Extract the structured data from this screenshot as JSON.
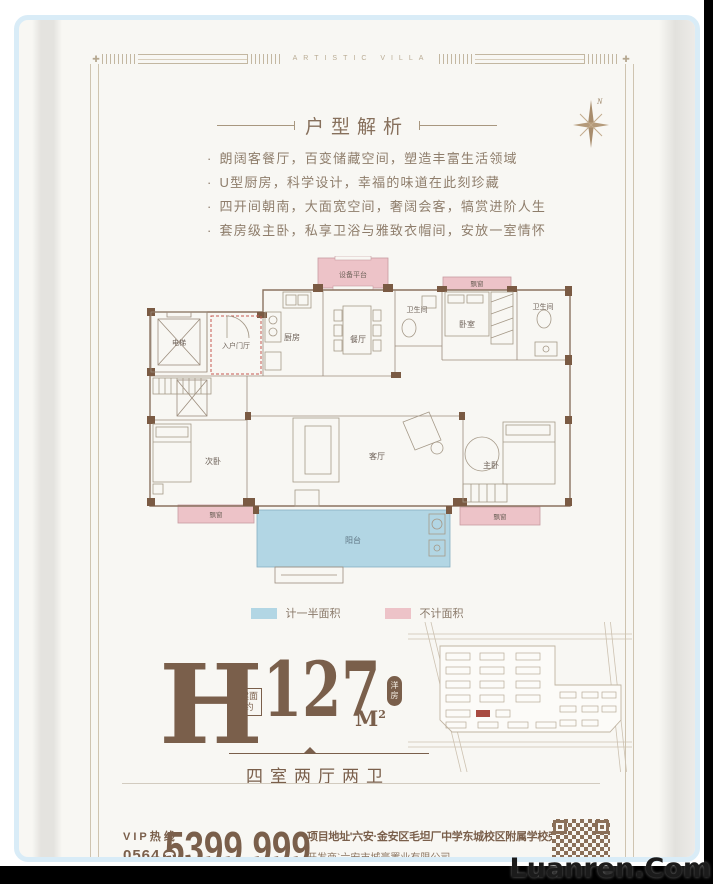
{
  "banner": {
    "border_title": "ARTISTIC VILLA",
    "compass_n": "N"
  },
  "section": {
    "title": "户型解析",
    "bullet_marker": "·",
    "bullets": [
      "朗阔客餐厅，百变储藏空间，塑造丰富生活领域",
      "U型厨房，科学设计，幸福的味道在此刻珍藏",
      "四开间朝南，大面宽空间，奢阔会客，犒赏进阶人生",
      "套房级主卧，私享卫浴与雅致衣帽间，安放一室情怀"
    ]
  },
  "floorplan": {
    "rooms": {
      "equipment": "设备平台",
      "bay_window": "飘窗",
      "elevator": "电梯",
      "entry": "入户门厅",
      "kitchen": "厨房",
      "dining": "餐厅",
      "bathroom": "卫生间",
      "bedroom": "卧室",
      "second_bedroom": "次卧",
      "living_room": "客厅",
      "master_bedroom": "主卧",
      "balcony": "阳台"
    },
    "legend": [
      {
        "label": "计一半面积",
        "color": "#b2d6e4",
        "swatch_style": "background:#b2d6e4"
      },
      {
        "label": "不计面积",
        "color": "#edc3c8",
        "swatch_style": "background:#edc3c8"
      }
    ]
  },
  "unit": {
    "letter": "H",
    "area_label": "建面约",
    "area_value": "127",
    "area_unit": "M",
    "area_sup": "2",
    "area_tag": "洋房",
    "layout": "四室两厅两卫"
  },
  "footer": {
    "vip_label": "VIP热线",
    "vip_code": "0564",
    "phone": "5399 999",
    "address": "项目地址'六安·金安区毛坦厂中学东城校区附属学校旁",
    "developer": "开发商`六安市城豪置业有限公司"
  },
  "icons": {
    "phone": "☎",
    "frame_cross": "✚"
  },
  "colors": {
    "paper": "#f8f7f3",
    "brown_text": "#7a5f4b",
    "frame_line": "#c3b7a1",
    "pink_area": "#edc3c8",
    "blue_area": "#b2d6e4",
    "wall": "#7a5a43",
    "highlight_building": "#a84a40",
    "photo_border": "#d9ecf7"
  },
  "watermark": "Luanren.Com"
}
